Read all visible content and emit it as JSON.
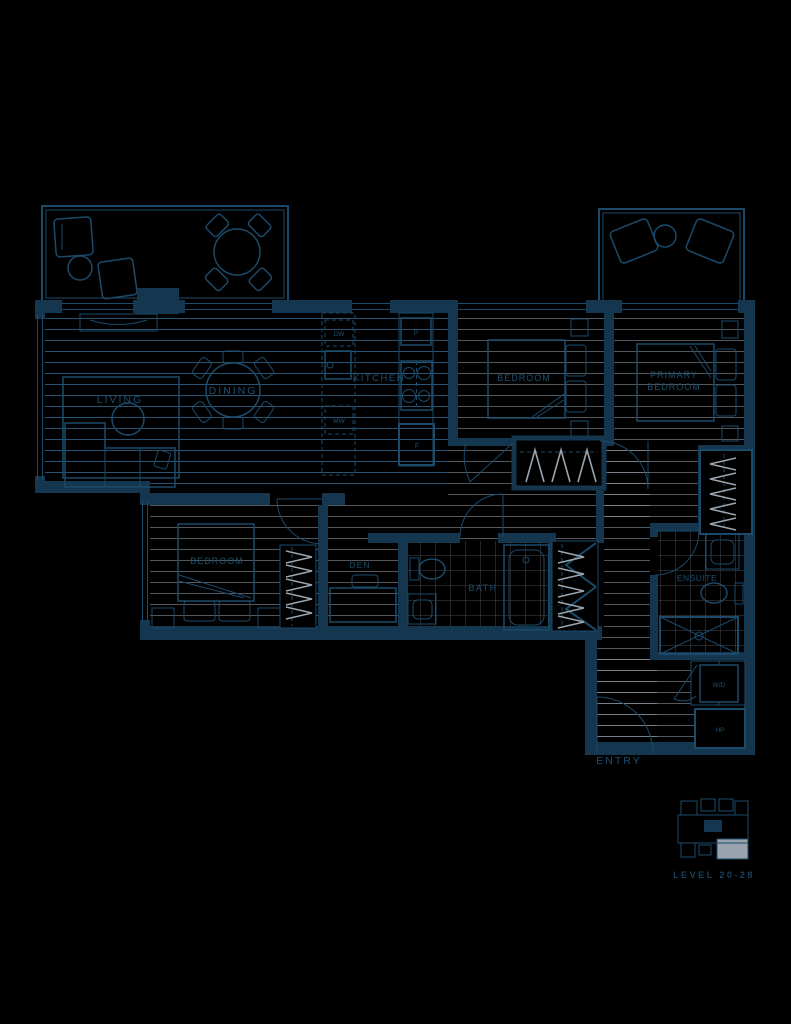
{
  "plan": {
    "rooms": {
      "living": "LIVING",
      "dining": "DINING",
      "kitchen": "KITCHEN",
      "bedroom_top": "BEDROOM",
      "primary_line1": "PRIMARY",
      "primary_line2": "BEDROOM",
      "bedroom_lower": "BEDROOM",
      "den": "DEN",
      "bath": "BATH",
      "ensuite": "ENSUITE",
      "entry": "ENTRY"
    },
    "appliances": {
      "dishwasher": "DW",
      "microwave": "MW",
      "pantry": "P",
      "fridge": "F",
      "washer_dryer": "W/D",
      "heat_pump": "HP"
    }
  },
  "keyplan": {
    "level_label": "LEVEL 20-28"
  },
  "colors": {
    "background": "#000000",
    "line": "#1b4a6a",
    "wall": "#14374f",
    "text": "#1d5070",
    "accent_gray": "#9aa4ae"
  }
}
